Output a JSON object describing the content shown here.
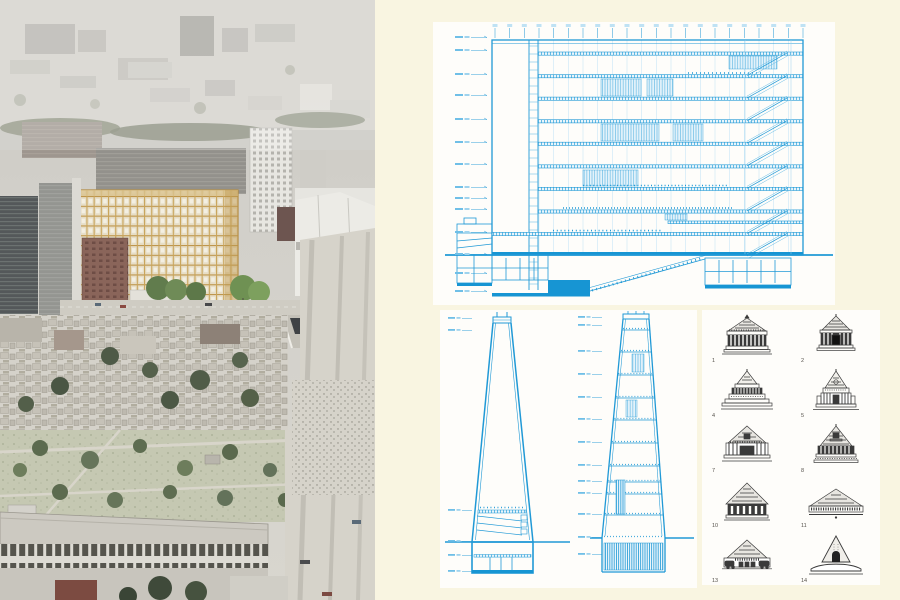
{
  "board": {
    "background_color": "#f9f5e1",
    "panel_color": "#fefdfa"
  },
  "photo": {
    "description": "Hazy aerial photograph of a dense city with a proposed golden lattice office block, park, plaza and long warehouse in the foreground",
    "highlight_building_color": "#c9a45a"
  },
  "drawings": {
    "ink_color": "#2099d6",
    "section": {
      "level_markers": 14,
      "column_grid_ticks": 22
    },
    "tower_left": {
      "level_markers": 6
    },
    "tower_right": {
      "level_markers": 13
    }
  },
  "precedents": {
    "ink_color": "#3a3a3a",
    "items": [
      {
        "number": "1"
      },
      {
        "number": "2"
      },
      {
        "number": "4"
      },
      {
        "number": "5"
      },
      {
        "number": "7"
      },
      {
        "number": "8"
      },
      {
        "number": "10"
      },
      {
        "number": "11"
      },
      {
        "number": "13"
      },
      {
        "number": "14"
      }
    ]
  }
}
